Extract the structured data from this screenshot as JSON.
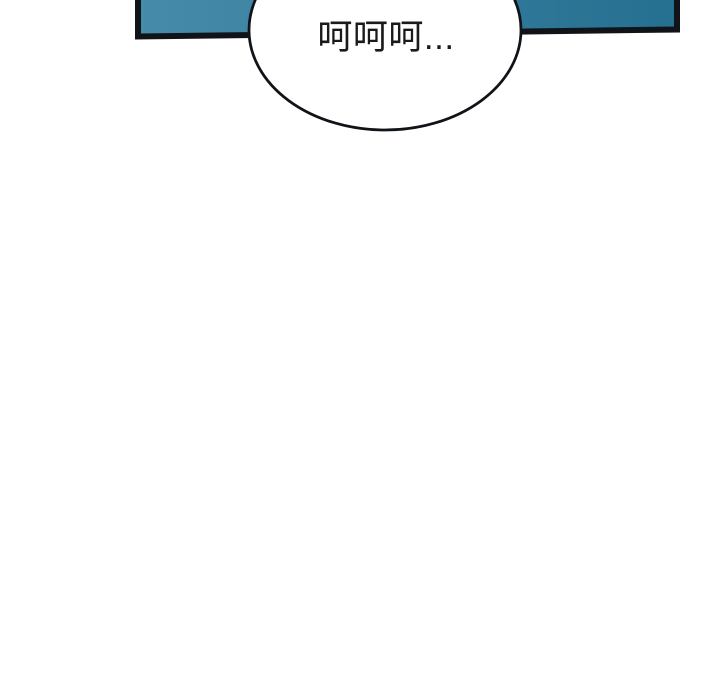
{
  "page": {
    "background_color": "#ffffff"
  },
  "panel": {
    "fill_left_color": "#478baa",
    "fill_right_color": "#256f90",
    "border_color": "#101418"
  },
  "speech_bubble": {
    "text": "呵呵呵...",
    "fill_color": "#ffffff",
    "border_color": "#101418",
    "text_color": "#1a1a1a"
  }
}
